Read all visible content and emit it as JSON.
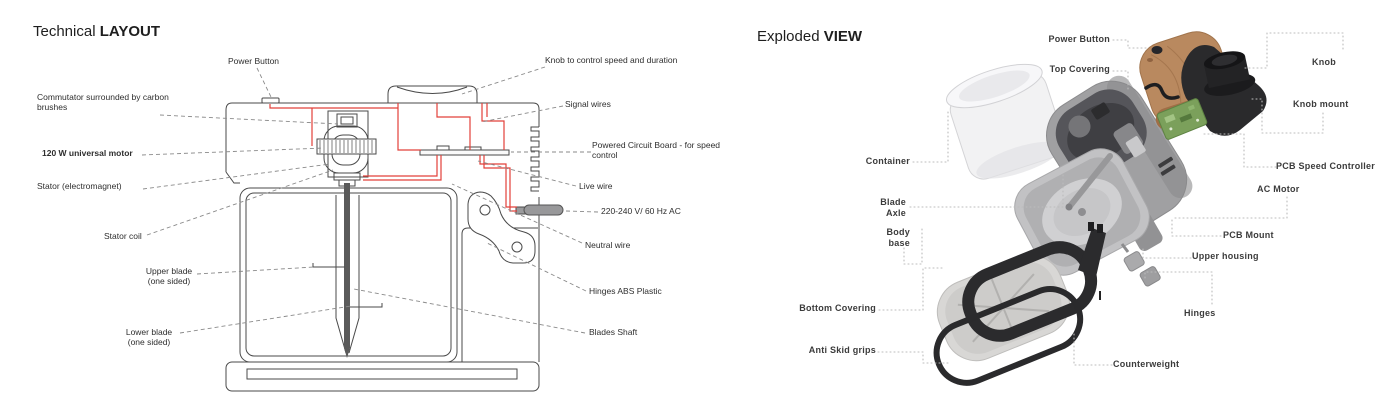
{
  "colors": {
    "wire_red": "#e2403a",
    "line_grey": "#4a4a4a",
    "leader_dash": "#8a8a8a",
    "leader_dot": "#bcbcbc",
    "wood": "#b9895f",
    "wood_dark": "#a06e46",
    "pcb_green": "#7ba05b",
    "metal_grey": "#a0a0a2",
    "black_part": "#2a2a2c"
  },
  "left_panel": {
    "title_normal": "Technical ",
    "title_bold": "LAYOUT",
    "labels": {
      "power_button": "Power Button",
      "knob_control": "Knob to control speed and duration",
      "commutator": "Commutator surrounded by carbon brushes",
      "signal_wires": "Signal wires",
      "motor": "120 W universal motor",
      "pcb": "Powered Circuit Board - for speed control",
      "stator": "Stator (electromagnet)",
      "live_wire": "Live wire",
      "voltage": "220-240 V/ 60 Hz AC",
      "stator_coil": "Stator coil",
      "neutral_wire": "Neutral wire",
      "upper_blade": "Upper blade (one sided)",
      "hinges_abs": "Hinges ABS Plastic",
      "lower_blade": "Lower blade (one sided)",
      "blades_shaft": "Blades Shaft"
    }
  },
  "right_panel": {
    "title_normal": "Exploded ",
    "title_bold": "VIEW",
    "labels": {
      "power_button": "Power Button",
      "top_covering": "Top Covering",
      "knob": "Knob",
      "knob_mount": "Knob mount",
      "container": "Container",
      "pcb_speed_controller": "PCB Speed Controller",
      "ac_motor": "AC Motor",
      "blade_axle": "Blade Axle",
      "body_base": "Body base",
      "pcb_mount": "PCB Mount",
      "upper_housing": "Upper housing",
      "bottom_covering": "Bottom Covering",
      "hinges": "Hinges",
      "anti_skid_grips": "Anti Skid grips",
      "counterweight": "Counterweight"
    }
  }
}
